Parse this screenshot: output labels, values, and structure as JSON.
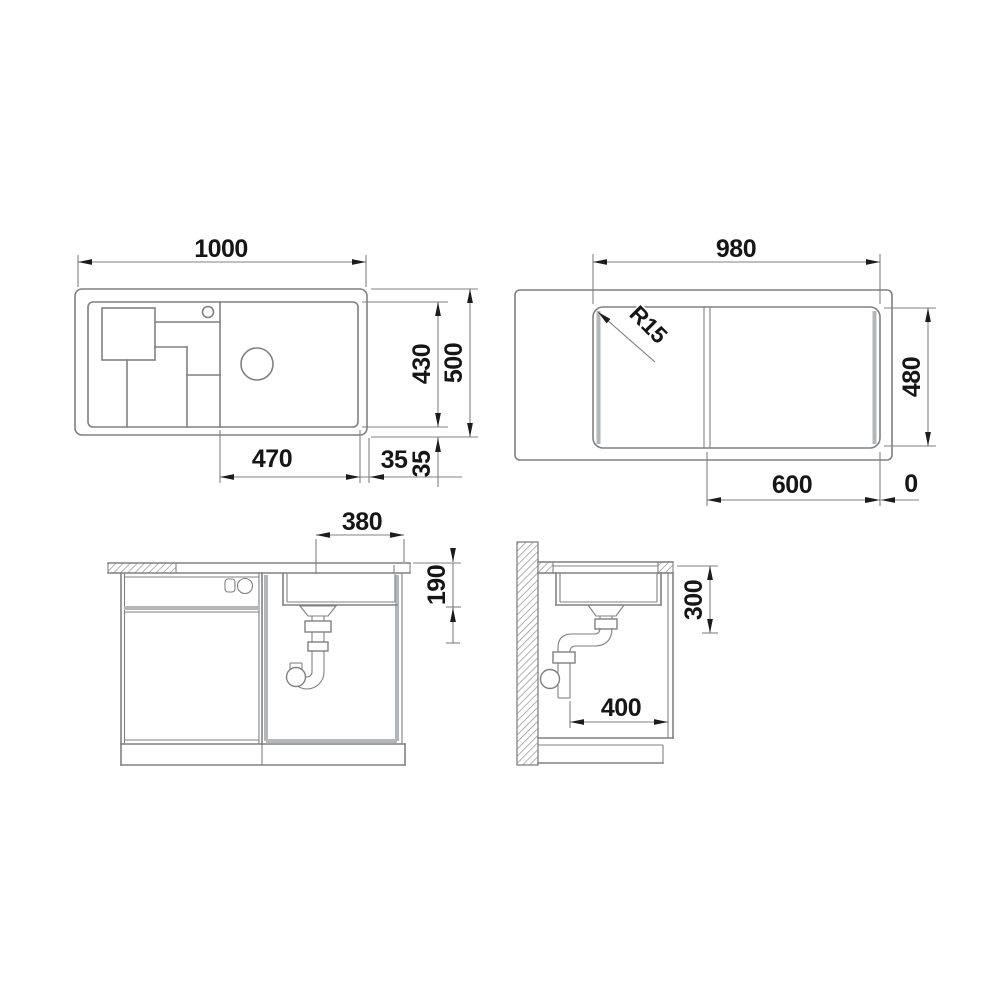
{
  "drawing_type": "kitchen sink installation technical drawing, four orthographic views",
  "labels": {
    "plan_width": "1000",
    "plan_height": "500",
    "plan_inner_height": "430",
    "plan_bowl_width": "470",
    "plan_rim_right": "35",
    "plan_rim_bottom": "35",
    "cutout_width": "980",
    "cutout_height": "480",
    "cutout_radius": "R15",
    "cutout_bowl_width": "600",
    "cutout_edge_offset": "0",
    "front_drain_offset": "380",
    "front_bowl_depth": "190",
    "side_clearance": "300",
    "side_drain_offset": "400"
  },
  "colors": {
    "line": "#808080",
    "accent": "#b4b7b9",
    "text": "#161616",
    "bg": "#ffffff"
  }
}
